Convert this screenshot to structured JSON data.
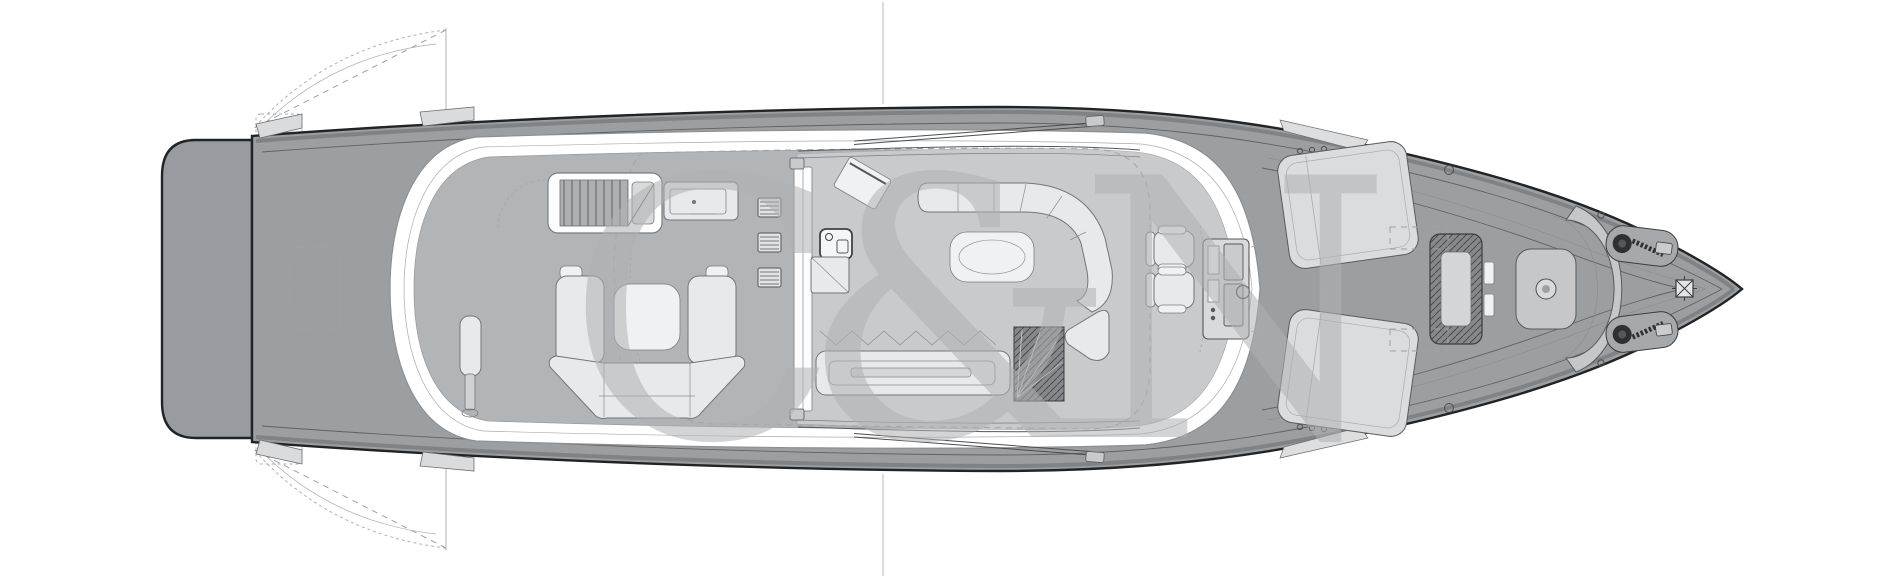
{
  "canvas": {
    "width": 1900,
    "height": 578,
    "background": "#ffffff"
  },
  "watermark": {
    "text": "C&N",
    "color": "#AFB2B4",
    "opacity": "0.55"
  },
  "colors": {
    "outline": "#212426",
    "deck": "#9B9FA2",
    "platform": "#989CA0",
    "covered_deck": "#B2B5B7",
    "salon_floor": "#C8CACC",
    "white_band": "#FFFFFF",
    "furniture_fill": "#E8E9EB",
    "furniture_stroke": "#72767A",
    "hatch_dark": "#85898C",
    "dashed_line": "#9FA2A5",
    "thin_line": "#5E6265"
  }
}
